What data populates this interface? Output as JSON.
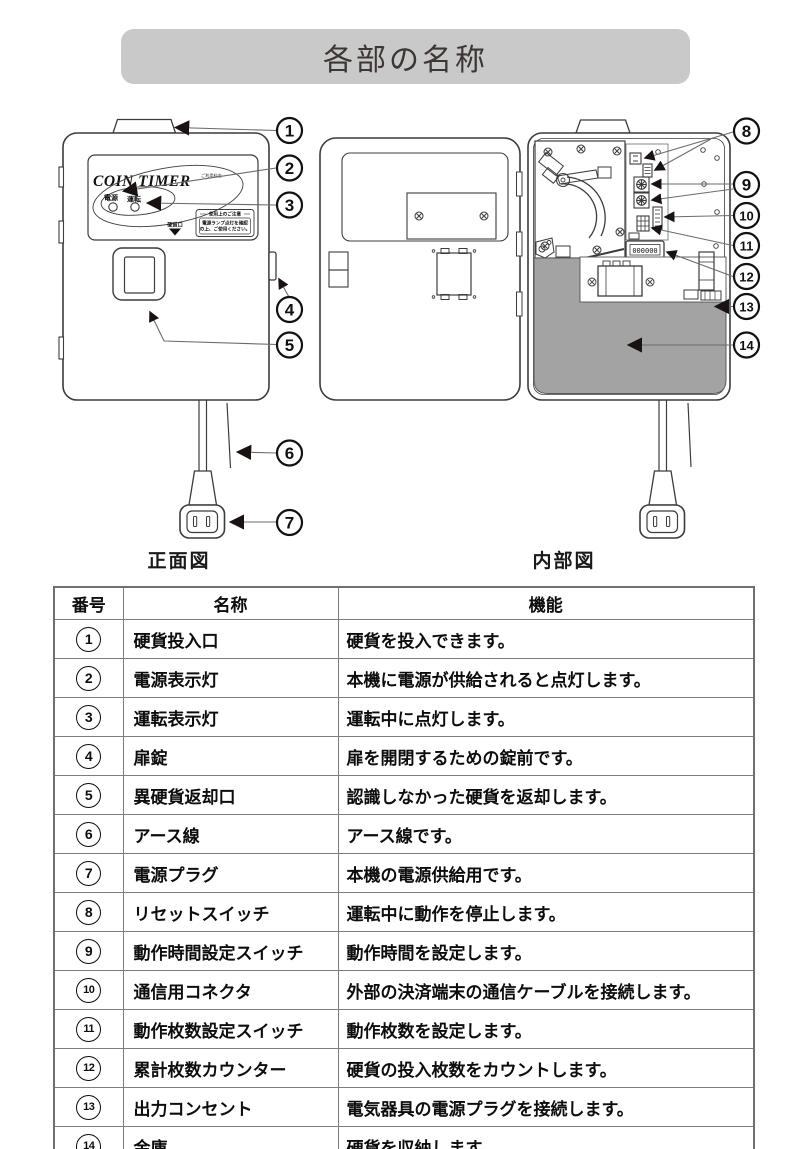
{
  "title": "各部の名称",
  "figure": {
    "front_caption": "正面図",
    "internal_caption": "内部図",
    "brand": "COIN TIMER",
    "brand_note": "ご利用料金",
    "power_led_label": "電源",
    "run_led_label": "運転",
    "notice_title": "使用上のご注意",
    "notice_body_1": "電源ランプ点灯を確認",
    "notice_body_2": "の上、ご使用ください。",
    "coin_slot_label": "硬貨口",
    "counter_value": "000000",
    "callouts": [
      "1",
      "2",
      "3",
      "4",
      "5",
      "6",
      "7",
      "8",
      "9",
      "10",
      "11",
      "12",
      "13",
      "14"
    ]
  },
  "table": {
    "headers": [
      "番号",
      "名称",
      "機能"
    ],
    "rows": [
      {
        "no": "1",
        "name": "硬貨投入口",
        "function": "硬貨を投入できます。"
      },
      {
        "no": "2",
        "name": "電源表示灯",
        "function": "本機に電源が供給されると点灯します。"
      },
      {
        "no": "3",
        "name": "運転表示灯",
        "function": "運転中に点灯します。"
      },
      {
        "no": "4",
        "name": "扉錠",
        "function": "扉を開閉するための錠前です。"
      },
      {
        "no": "5",
        "name": "異硬貨返却口",
        "function": "認識しなかった硬貨を返却します。"
      },
      {
        "no": "6",
        "name": "アース線",
        "function": "アース線です。"
      },
      {
        "no": "7",
        "name": "電源プラグ",
        "function": "本機の電源供給用です。"
      },
      {
        "no": "8",
        "name": "リセットスイッチ",
        "function": "運転中に動作を停止します。"
      },
      {
        "no": "9",
        "name": "動作時間設定スイッチ",
        "function": "動作時間を設定します。"
      },
      {
        "no": "10",
        "name": "通信用コネクタ",
        "function": "外部の決済端末の通信ケーブルを接続します。"
      },
      {
        "no": "11",
        "name": "動作枚数設定スイッチ",
        "function": "動作枚数を設定します。"
      },
      {
        "no": "12",
        "name": "累計枚数カウンター",
        "function": "硬貨の投入枚数をカウントします。"
      },
      {
        "no": "13",
        "name": "出力コンセント",
        "function": "電気器具の電源プラグを接続します。"
      },
      {
        "no": "14",
        "name": "金庫",
        "function": "硬貨を収納します。"
      }
    ]
  },
  "colors": {
    "title_bar_bg": "#c9c9c9",
    "title_text": "#3c3634",
    "safe_box_fill": "#a3a3a3",
    "line_art": "#3c3c3c",
    "table_border": "#7d7d7d"
  }
}
